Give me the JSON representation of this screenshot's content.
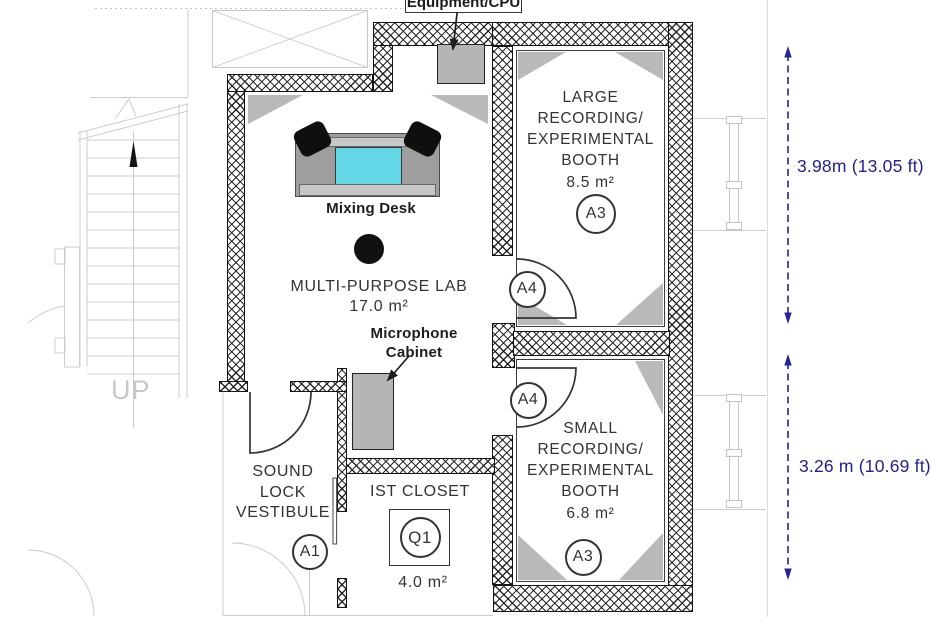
{
  "colors": {
    "dimension_blue": "#1f1f96",
    "wall_line": "#141414",
    "gray_fill": "#b5b5b5",
    "screen_cyan": "#63d7e6",
    "triangle_gray": "#b9b9b9",
    "faded_gray": "#cccccc"
  },
  "equipment_label": "Equipment/CPU",
  "rooms": {
    "lab": {
      "name": "MULTI-PURPOSE LAB",
      "area": "17.0 m²"
    },
    "large_booth": {
      "lines": [
        "LARGE",
        "RECORDING/",
        "EXPERIMENTAL",
        "BOOTH"
      ],
      "area": "8.5 m²",
      "tag": "A3"
    },
    "small_booth": {
      "lines": [
        "SMALL",
        "RECORDING/",
        "EXPERIMENTAL",
        "BOOTH"
      ],
      "area": "6.8 m²",
      "tag": "A3"
    },
    "vestibule": {
      "lines": [
        "SOUND",
        "LOCK",
        "VESTIBULE"
      ],
      "tag": "A1"
    },
    "closet": {
      "name": "IST CLOSET",
      "area": "4.0 m²",
      "tag": "Q1"
    }
  },
  "doors": {
    "upper_tag": "A4",
    "lower_tag": "A4"
  },
  "furniture": {
    "mixing_desk": "Mixing Desk",
    "microphone_cabinet": [
      "Microphone",
      "Cabinet"
    ]
  },
  "stairs": {
    "label": "UP"
  },
  "dimensions": [
    {
      "label": "3.98m (13.05 ft)"
    },
    {
      "label": "3.26 m (10.69 ft)"
    }
  ]
}
